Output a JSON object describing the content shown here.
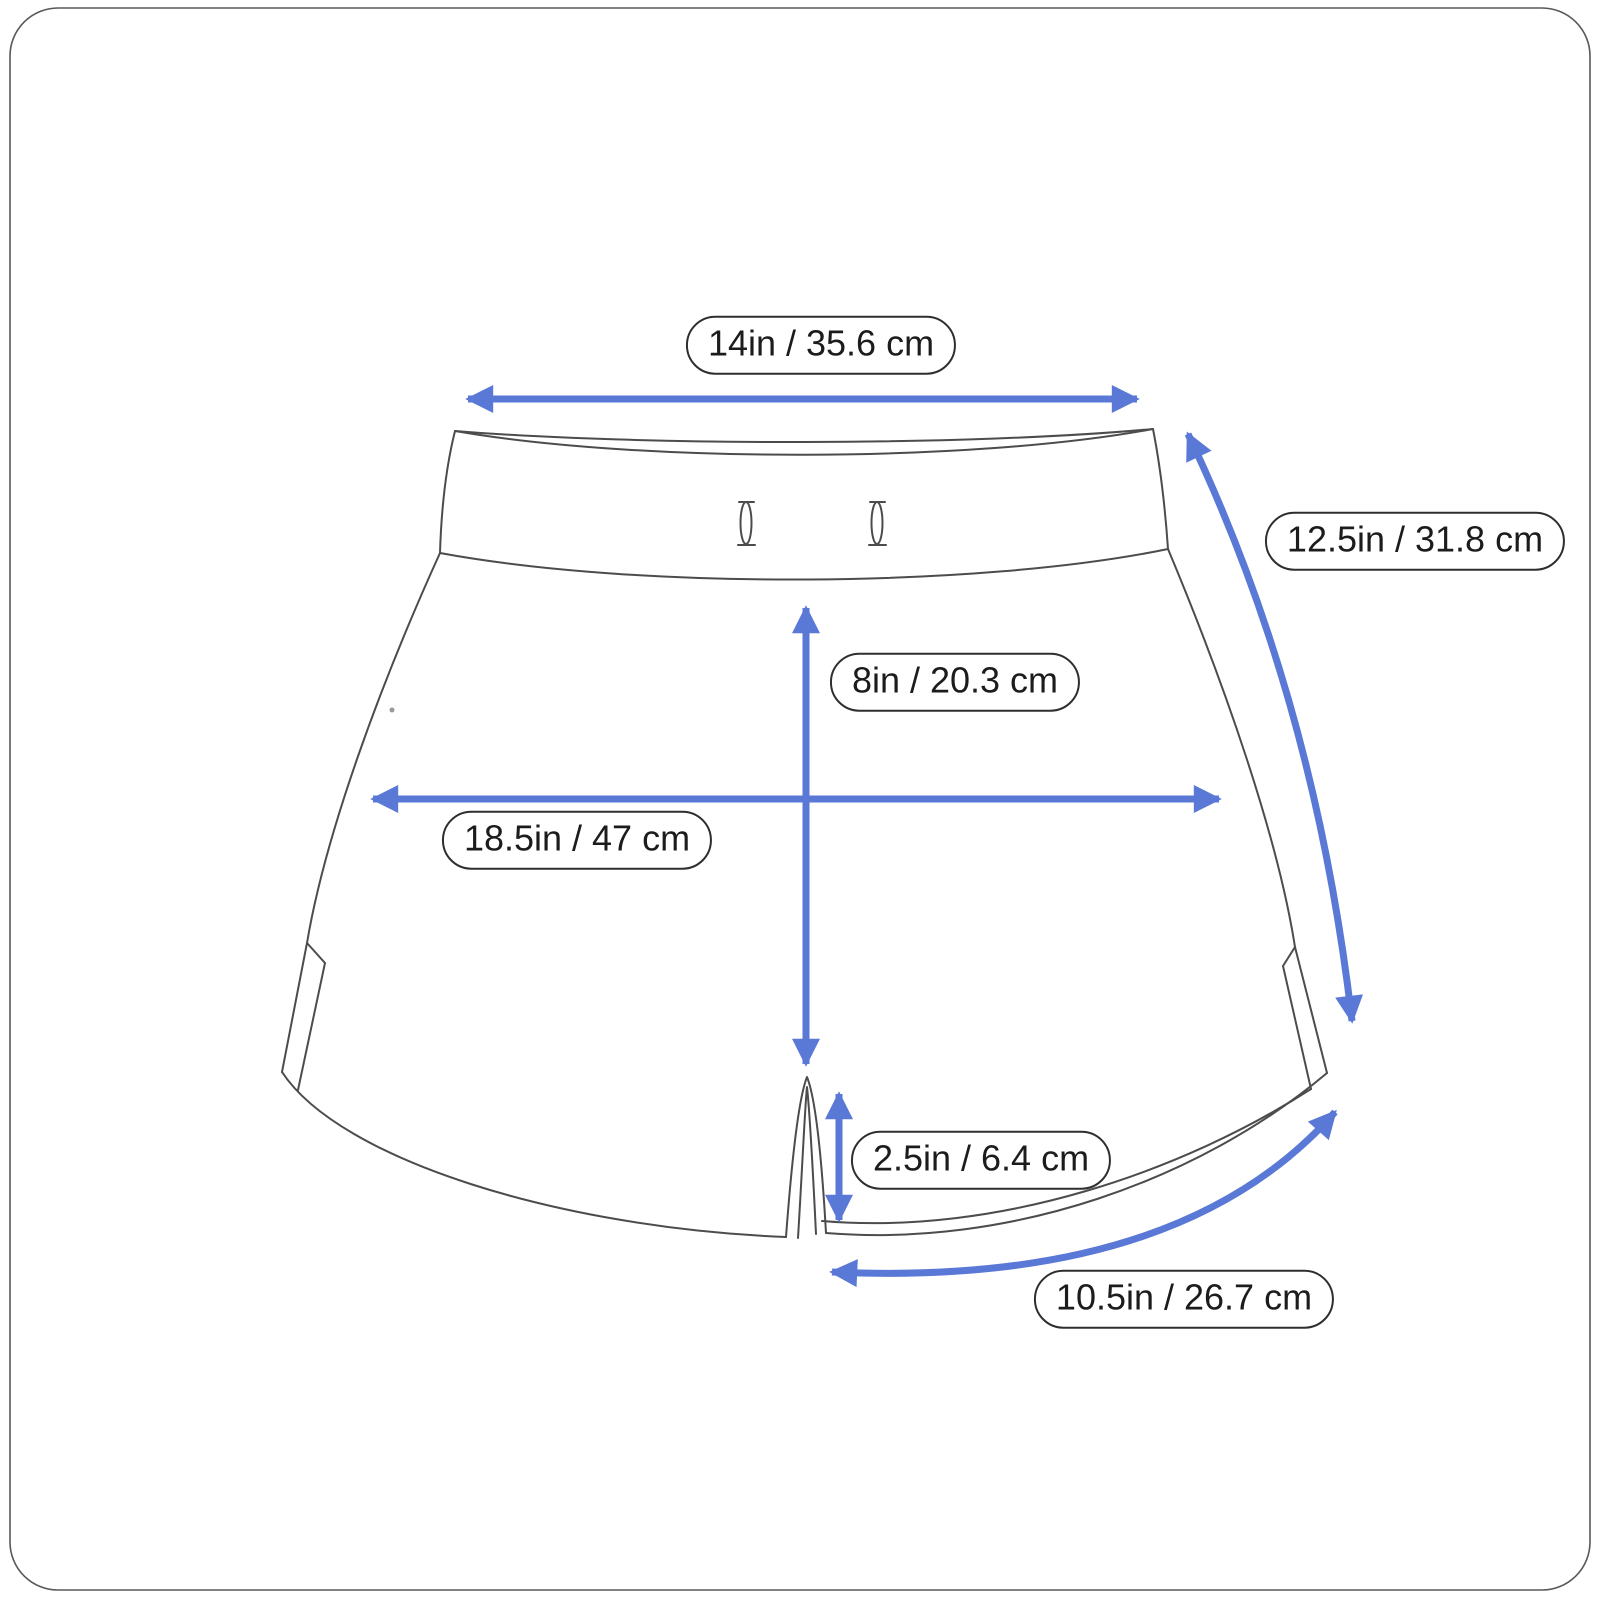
{
  "measurements": {
    "waist_width": {
      "label": "14in / 35.6 cm"
    },
    "side_length": {
      "label": "12.5in / 31.8 cm"
    },
    "front_rise": {
      "label": "8in / 20.3 cm"
    },
    "sweep_width": {
      "label": "18.5in / 47 cm"
    },
    "side_slit": {
      "label": "2.5in / 6.4 cm"
    },
    "leg_opening": {
      "label": "10.5in / 26.7 cm"
    }
  },
  "colors": {
    "arrow_blue": "#5a79d6",
    "outline_gray": "#4c4c4c",
    "pill_border": "#2e2e2e",
    "pill_background": "#ffffff",
    "background": "#ffffff"
  }
}
